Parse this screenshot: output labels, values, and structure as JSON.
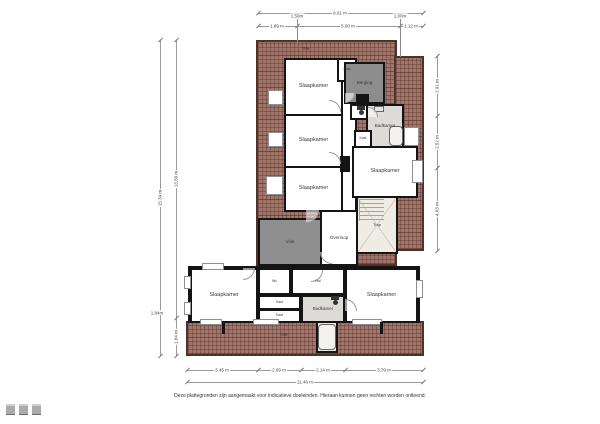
{
  "meta": {
    "disclaimer": "Deze plattegronden zijn aangemaakt voor indicatieve doeleinden. Hieraan kunnen geen rechten worden ontleend."
  },
  "palette": {
    "roof_hatch": "#a3766c",
    "roof_border": "#4e332b",
    "wall": "#141414",
    "floor_white": "#ffffff",
    "floor_gray": "#8d8d8d",
    "floor_dark_gray": "#8f8f8f",
    "floor_bath": "#dcdbd7",
    "floor_stairs": "#efece6",
    "dim_line": "#9a9a9a"
  },
  "hatches": [
    {
      "name": "roof-upper-left",
      "x": 256,
      "y": 40,
      "w": 141,
      "h": 226
    },
    {
      "name": "roof-upper-right",
      "x": 394,
      "y": 56,
      "w": 30,
      "h": 195
    },
    {
      "name": "roof-bottom-strip",
      "x": 186,
      "y": 321,
      "w": 238,
      "h": 35
    }
  ],
  "roof_labels": [
    {
      "t": "Dak",
      "x": 306,
      "y": 48
    },
    {
      "t": "Dak",
      "x": 284,
      "y": 334
    }
  ],
  "rooms": [
    {
      "name": "room-slaapkamer-1",
      "x": 284,
      "y": 58,
      "w": 59,
      "h": 58,
      "fill": "#ffffff",
      "label": "Slaapkamer"
    },
    {
      "name": "room-overloop-corridor",
      "x": 341,
      "y": 58,
      "w": 16,
      "h": 154,
      "fill": "#ffffff",
      "label": ""
    },
    {
      "name": "room-kast-1",
      "x": 337,
      "y": 58,
      "w": 20,
      "h": 24,
      "fill": "#ffffff",
      "label": "Kast",
      "ls": 3.5
    },
    {
      "name": "room-berging",
      "x": 344,
      "y": 62,
      "w": 41,
      "h": 42,
      "fill": "#8d8d8d",
      "label": "Berging",
      "ls": 4.5
    },
    {
      "name": "room-wc-boven",
      "x": 350,
      "y": 104,
      "w": 22,
      "h": 16,
      "fill": "#ffffff",
      "label": ""
    },
    {
      "name": "room-badkamer-1",
      "x": 366,
      "y": 104,
      "w": 38,
      "h": 44,
      "fill": "#dcdbd7",
      "label": "Badkamer",
      "ls": 4.5
    },
    {
      "name": "room-kast-2",
      "x": 354,
      "y": 130,
      "w": 18,
      "h": 18,
      "fill": "#ffffff",
      "label": "Kast",
      "ls": 3.5
    },
    {
      "name": "room-slaapkamer-2",
      "x": 284,
      "y": 114,
      "w": 59,
      "h": 54,
      "fill": "#ffffff",
      "label": "Slaapkamer"
    },
    {
      "name": "room-slaapkamer-3",
      "x": 284,
      "y": 166,
      "w": 59,
      "h": 46,
      "fill": "#ffffff",
      "label": "Slaapkamer"
    },
    {
      "name": "room-slaapkamer-4",
      "x": 352,
      "y": 146,
      "w": 66,
      "h": 52,
      "fill": "#ffffff",
      "label": "Slaapkamer"
    },
    {
      "name": "room-overloop",
      "x": 320,
      "y": 210,
      "w": 38,
      "h": 56,
      "fill": "#ffffff",
      "label": "Overloop",
      "ls": 4.5
    },
    {
      "name": "room-trap",
      "x": 356,
      "y": 196,
      "w": 42,
      "h": 58,
      "fill": "#efece6",
      "label": "Trap",
      "ls": 4,
      "stairs": true
    },
    {
      "name": "room-vide",
      "x": 258,
      "y": 218,
      "w": 64,
      "h": 48,
      "fill": "#8f8f8f",
      "label": "Vide",
      "ls": 4.5
    },
    {
      "name": "room-lower-base",
      "x": 188,
      "y": 266,
      "w": 232,
      "h": 57,
      "fill": "#ffffff",
      "label": ""
    },
    {
      "name": "room-slaapkamer-5",
      "x": 190,
      "y": 268,
      "w": 68,
      "h": 55,
      "fill": "#ffffff",
      "label": "Slaapkamer"
    },
    {
      "name": "room-wc-beneden",
      "x": 258,
      "y": 268,
      "w": 33,
      "h": 27,
      "fill": "#ffffff",
      "label": "Wc",
      "ls": 3.5
    },
    {
      "name": "room-hal",
      "x": 291,
      "y": 268,
      "w": 54,
      "h": 27,
      "fill": "#ffffff",
      "label": "Hal",
      "ls": 3.5
    },
    {
      "name": "room-kast-3",
      "x": 258,
      "y": 295,
      "w": 43,
      "h": 15,
      "fill": "#ffffff",
      "label": "Kast",
      "ls": 3.5,
      "stripes": true
    },
    {
      "name": "room-kast-4",
      "x": 258,
      "y": 309,
      "w": 43,
      "h": 14,
      "fill": "#ffffff",
      "label": "Kast",
      "ls": 3.5,
      "stripes": true
    },
    {
      "name": "room-badkamer-2",
      "x": 301,
      "y": 295,
      "w": 44,
      "h": 28,
      "fill": "#dcdbd7",
      "label": "Badkamer",
      "ls": 4.5
    },
    {
      "name": "room-slaapkamer-6",
      "x": 345,
      "y": 268,
      "w": 73,
      "h": 55,
      "fill": "#ffffff",
      "label": "Slaapkamer"
    },
    {
      "name": "room-shower-alcove",
      "x": 316,
      "y": 321,
      "w": 22,
      "h": 32,
      "fill": "#e9e8e4",
      "label": ""
    }
  ],
  "niches": [
    {
      "name": "window-dormer-left-1",
      "x": 268,
      "y": 90,
      "w": 15,
      "h": 15
    },
    {
      "name": "window-dormer-left-2",
      "x": 268,
      "y": 132,
      "w": 15,
      "h": 15
    },
    {
      "name": "window-dormer-left-3",
      "x": 266,
      "y": 176,
      "w": 17,
      "h": 19
    },
    {
      "name": "window-dormer-right-1",
      "x": 404,
      "y": 127,
      "w": 15,
      "h": 19
    },
    {
      "name": "window-dormer-right-2",
      "x": 412,
      "y": 160,
      "w": 11,
      "h": 23
    },
    {
      "name": "window-lower-left-1",
      "x": 184,
      "y": 276,
      "w": 7,
      "h": 13
    },
    {
      "name": "window-lower-left-2",
      "x": 184,
      "y": 302,
      "w": 7,
      "h": 13
    },
    {
      "name": "window-lower-top",
      "x": 202,
      "y": 263,
      "w": 22,
      "h": 7
    },
    {
      "name": "window-lower-right",
      "x": 416,
      "y": 280,
      "w": 7,
      "h": 18
    },
    {
      "name": "window-bottom-1",
      "x": 200,
      "y": 319,
      "w": 22,
      "h": 6
    },
    {
      "name": "window-bottom-2",
      "x": 253,
      "y": 319,
      "w": 26,
      "h": 6
    },
    {
      "name": "window-bottom-3",
      "x": 352,
      "y": 319,
      "w": 30,
      "h": 6
    }
  ],
  "shafts": [
    {
      "name": "shaft-1",
      "x": 356,
      "y": 94,
      "w": 13,
      "h": 10
    },
    {
      "name": "shaft-2",
      "x": 340,
      "y": 156,
      "w": 10,
      "h": 16
    },
    {
      "name": "wall-stub-1",
      "x": 222,
      "y": 322,
      "w": 3,
      "h": 12
    },
    {
      "name": "wall-stub-2",
      "x": 380,
      "y": 322,
      "w": 3,
      "h": 12
    }
  ],
  "fixtures": [
    {
      "name": "bathtub-1",
      "type": "tub",
      "x": 389,
      "y": 126,
      "w": 14,
      "h": 20
    },
    {
      "name": "shower-tray",
      "type": "tub",
      "x": 318,
      "y": 324,
      "w": 18,
      "h": 26
    },
    {
      "name": "toilet-1",
      "type": "wc",
      "x": 357,
      "y": 106
    },
    {
      "name": "toilet-2",
      "type": "wc",
      "x": 331,
      "y": 296
    },
    {
      "name": "washbasin-1",
      "type": "sink",
      "x": 374,
      "y": 106,
      "w": 10,
      "h": 6
    }
  ],
  "doors": [
    {
      "name": "door-slaapkamer-1",
      "x": 329,
      "y": 100,
      "s": 12,
      "rot": 0
    },
    {
      "name": "door-slaapkamer-2",
      "x": 329,
      "y": 152,
      "s": 12,
      "rot": 0
    },
    {
      "name": "door-vide",
      "x": 306,
      "y": 210,
      "s": 13,
      "rot": 90
    },
    {
      "name": "door-berging",
      "x": 345,
      "y": 93,
      "s": 10,
      "rot": 90
    },
    {
      "name": "door-badkamer-1",
      "x": 368,
      "y": 107,
      "s": 10,
      "rot": 0
    },
    {
      "name": "door-hal",
      "x": 311,
      "y": 270,
      "s": 12,
      "rot": 90
    },
    {
      "name": "door-slaapkamer-6",
      "x": 345,
      "y": 299,
      "s": 12,
      "rot": 0
    },
    {
      "name": "door-slaapkamer-5",
      "x": 243,
      "y": 268,
      "s": 12,
      "rot": 90
    },
    {
      "name": "door-overloop",
      "x": 320,
      "y": 252,
      "s": 12,
      "rot": 180
    }
  ],
  "dims": [
    {
      "o": "h",
      "x1": 258,
      "x2": 423,
      "y": 13,
      "bounds": [
        258,
        423
      ],
      "labels": [
        {
          "t": "8.01 m",
          "at": 340
        }
      ]
    },
    {
      "o": "h",
      "x1": 258,
      "x2": 423,
      "y": 26,
      "bounds": [
        258,
        297,
        400,
        423
      ],
      "labels": [
        {
          "t": "1.89 m",
          "at": 277
        },
        {
          "t": "5.00 m",
          "at": 348
        },
        {
          "t": "1.12 m",
          "at": 411
        }
      ]
    },
    {
      "o": "v",
      "x": 160,
      "y1": 40,
      "y2": 356,
      "bounds": [
        40,
        356
      ],
      "labels": [
        {
          "t": "15.34 m",
          "at": 198
        }
      ]
    },
    {
      "o": "v",
      "x": 176,
      "y1": 40,
      "y2": 356,
      "bounds": [
        40,
        318,
        356
      ],
      "labels": [
        {
          "t": "13.50 m",
          "at": 179
        },
        {
          "t": "1.84 m",
          "at": 337
        }
      ]
    },
    {
      "o": "v",
      "x": 437,
      "y1": 56,
      "y2": 251,
      "bounds": [
        56,
        116,
        168,
        251
      ],
      "labels": [
        {
          "t": "2.91 m",
          "at": 86
        },
        {
          "t": "2.52 m",
          "at": 142
        },
        {
          "t": "4.03 m",
          "at": 209
        }
      ]
    },
    {
      "o": "h",
      "x1": 187,
      "x2": 423,
      "y": 370,
      "bounds": [
        187,
        258,
        301,
        345,
        423
      ],
      "labels": [
        {
          "t": "3.45 m",
          "at": 222
        },
        {
          "t": "2.09 m",
          "at": 279
        },
        {
          "t": "2.14 m",
          "at": 323
        },
        {
          "t": "3.79 m",
          "at": 384
        }
      ]
    },
    {
      "o": "h",
      "x1": 187,
      "x2": 423,
      "y": 382,
      "bounds": [
        187,
        423
      ],
      "labels": [
        {
          "t": "11.46 m",
          "at": 305
        }
      ]
    }
  ],
  "marks": [
    {
      "name": "dormer-mark-1",
      "x": 297,
      "y1": 19,
      "y2": 44,
      "label": "1.50m"
    },
    {
      "name": "dormer-mark-2",
      "x": 400,
      "y1": 19,
      "y2": 57,
      "label": "1.00m"
    }
  ],
  "mini_label": {
    "t": "1.84m",
    "x": 157,
    "y": 313
  },
  "logo_marks": [
    {
      "name": "logo-mark-1"
    },
    {
      "name": "logo-mark-2"
    },
    {
      "name": "logo-mark-3"
    }
  ]
}
